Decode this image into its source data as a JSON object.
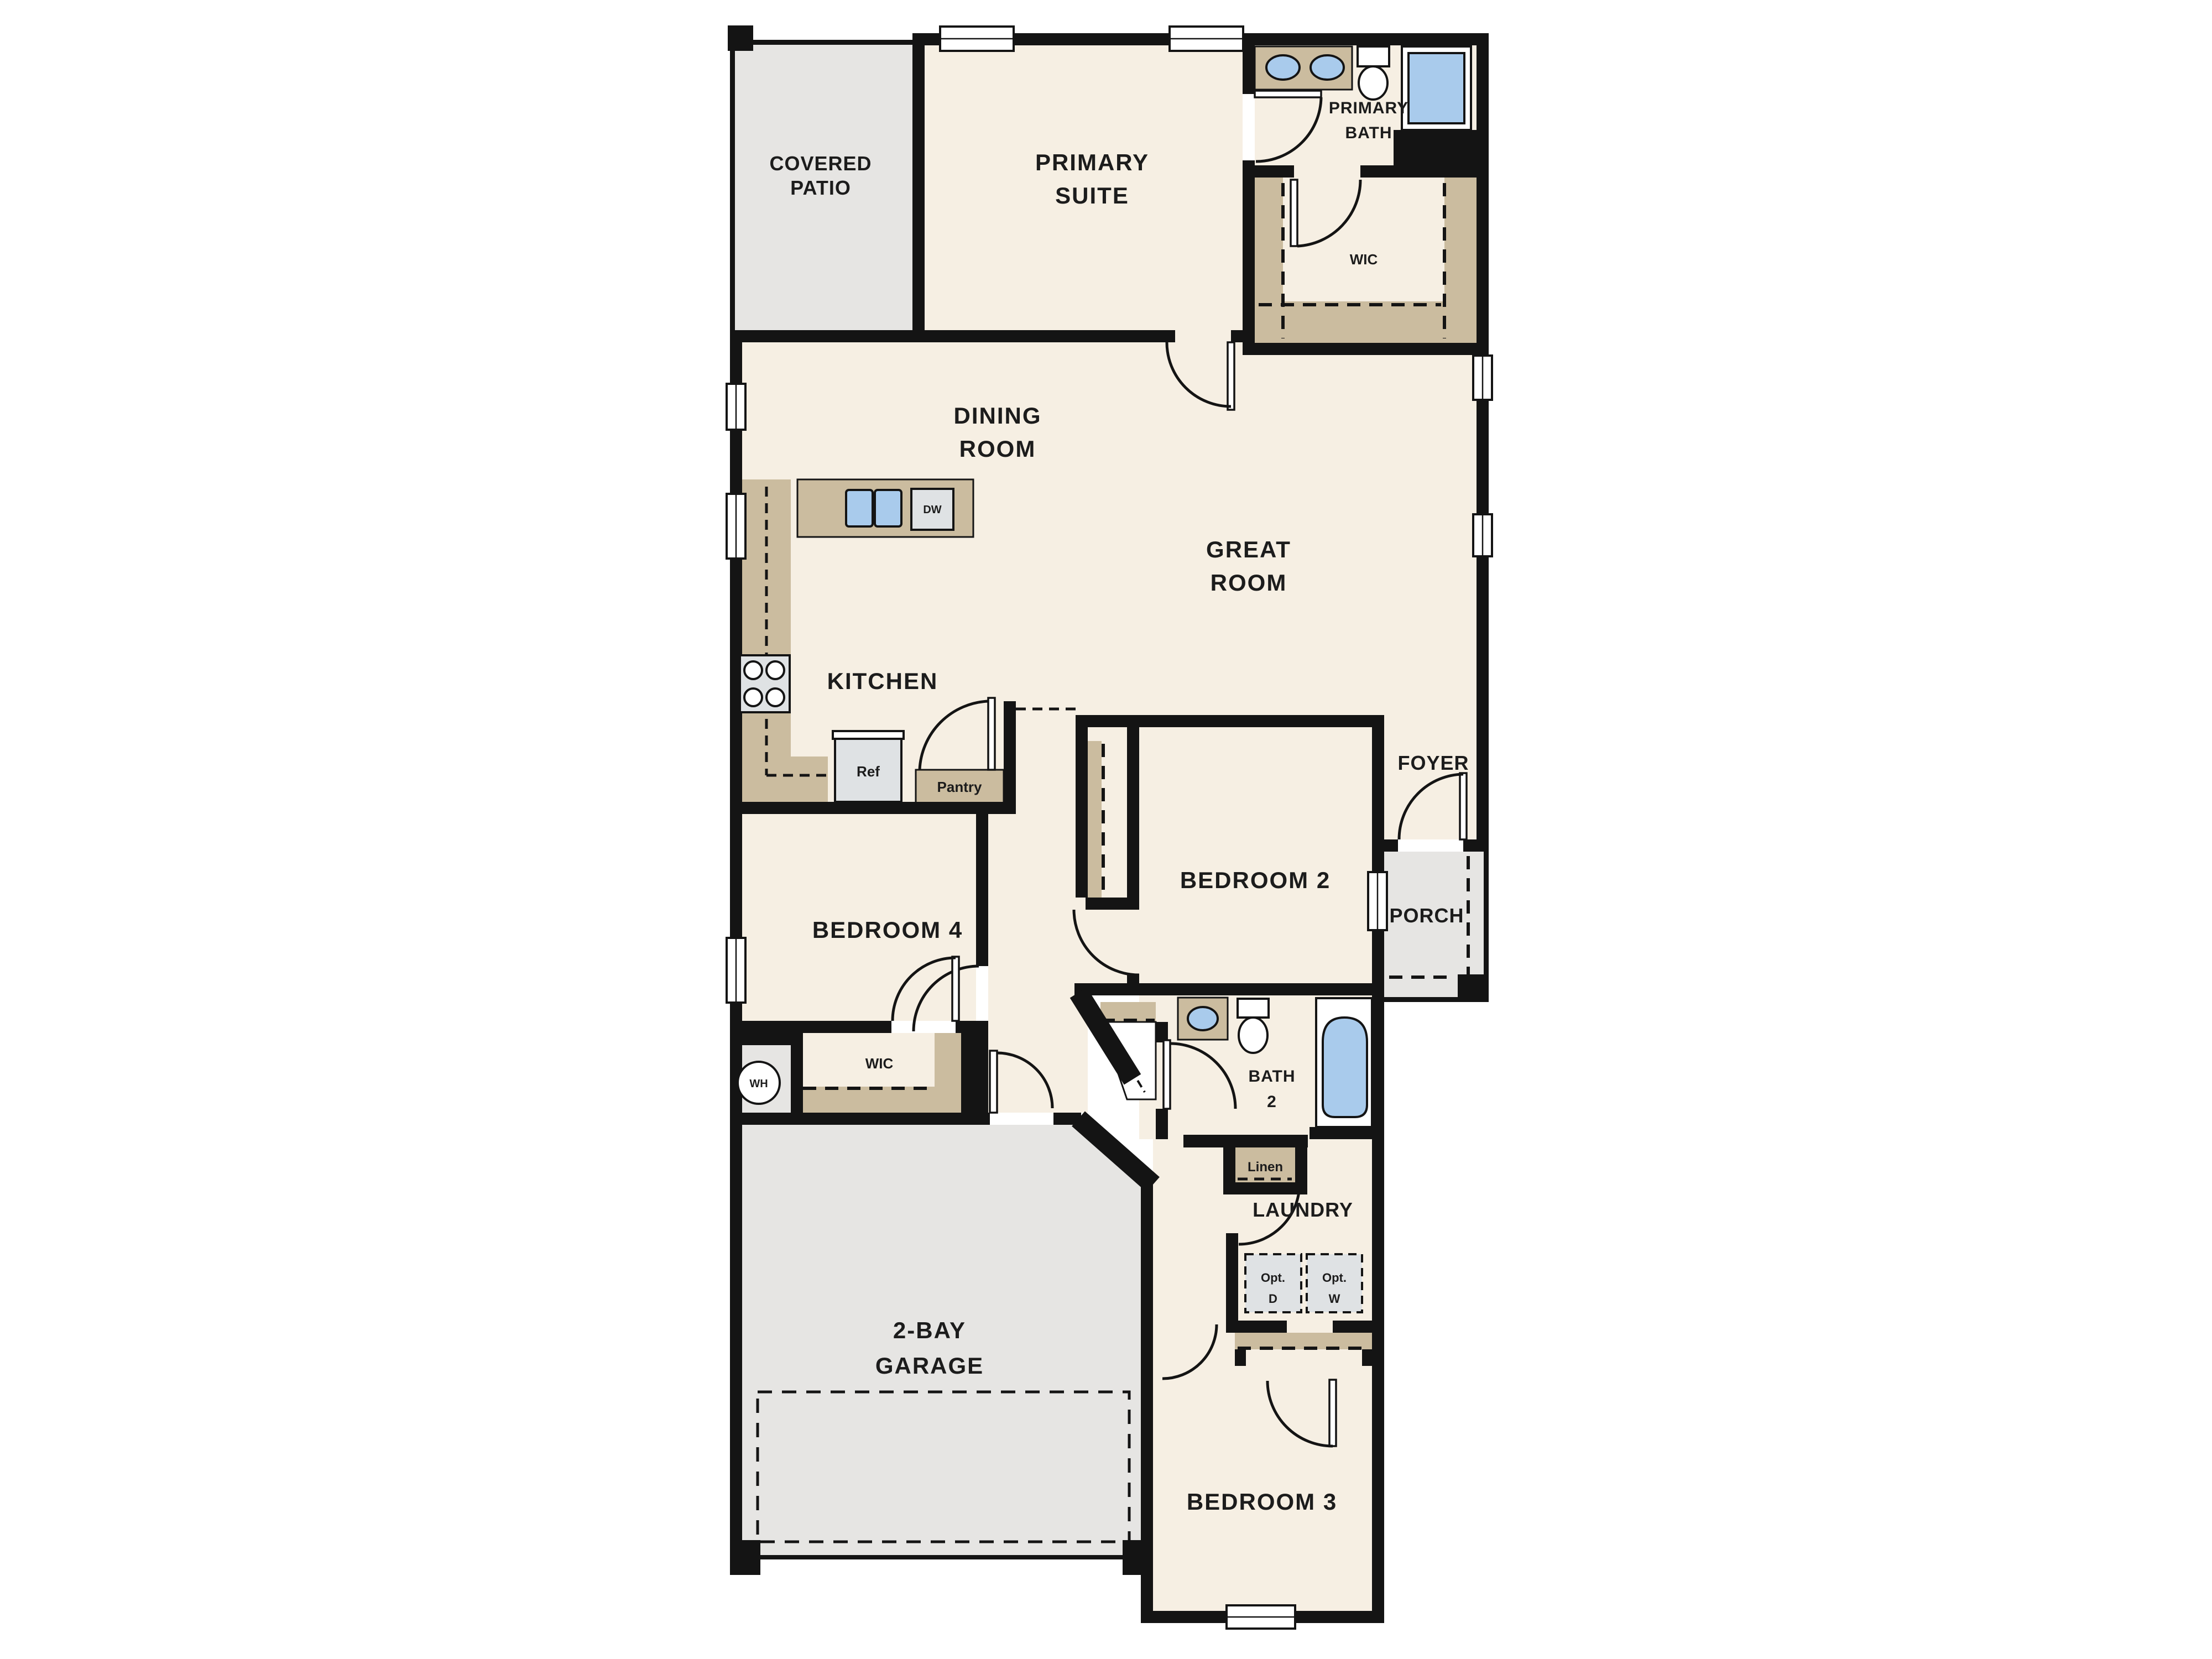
{
  "palette": {
    "wall": "#141414",
    "room_floor": "#f6efe3",
    "outdoor_concrete": "#e6e5e3",
    "cabinetry_tan": "#cbbc9f",
    "fixture_blue": "#a9cbec",
    "appliance_gray": "#dfe2e4",
    "label_text": "#1c1c1c"
  },
  "rooms": {
    "covered_patio": {
      "lines": [
        "COVERED",
        "PATIO"
      ]
    },
    "primary_suite": {
      "lines": [
        "PRIMARY",
        "SUITE"
      ]
    },
    "primary_bath": {
      "lines": [
        "PRIMARY",
        "BATH"
      ]
    },
    "primary_wic": {
      "lines": [
        "WIC"
      ]
    },
    "dining_room": {
      "lines": [
        "DINING",
        "ROOM"
      ]
    },
    "great_room": {
      "lines": [
        "GREAT",
        "ROOM"
      ]
    },
    "kitchen": {
      "lines": [
        "KITCHEN"
      ]
    },
    "foyer": {
      "lines": [
        "FOYER"
      ]
    },
    "porch": {
      "lines": [
        "PORCH"
      ]
    },
    "bedroom_2": {
      "lines": [
        "BEDROOM 2"
      ]
    },
    "bedroom_4": {
      "lines": [
        "BEDROOM 4"
      ]
    },
    "bedroom_4_wic": {
      "lines": [
        "WIC"
      ]
    },
    "bath_2": {
      "lines": [
        "BATH",
        "2"
      ]
    },
    "laundry": {
      "lines": [
        "LAUNDRY"
      ]
    },
    "garage": {
      "lines": [
        "2-BAY",
        "GARAGE"
      ]
    },
    "bedroom_3": {
      "lines": [
        "BEDROOM 3"
      ]
    }
  },
  "fixtures": {
    "water_heater": "WH",
    "refrigerator": "Ref",
    "pantry": "Pantry",
    "dishwasher": "DW",
    "linen": "Linen",
    "optional_dryer": {
      "lines": [
        "Opt.",
        "D"
      ]
    },
    "optional_washer": {
      "lines": [
        "Opt.",
        "W"
      ]
    }
  }
}
